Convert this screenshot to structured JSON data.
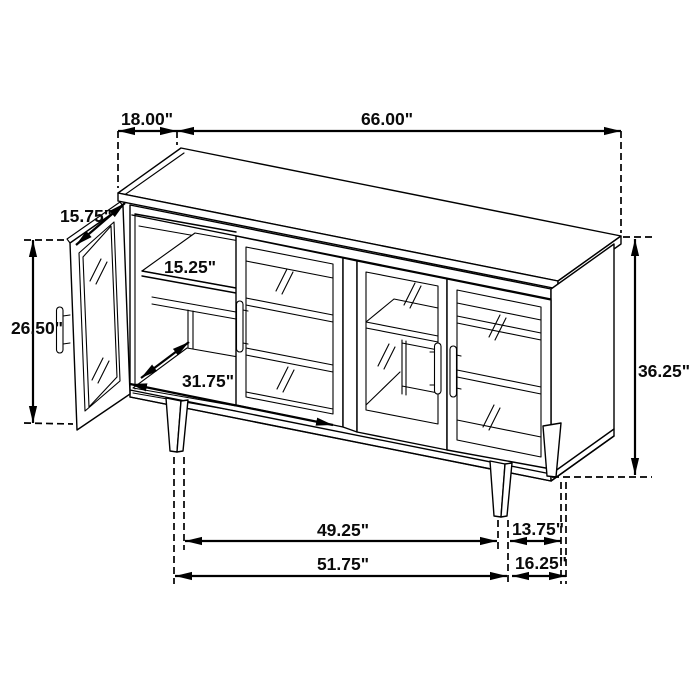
{
  "figure": {
    "type": "furniture-dimension-diagram",
    "subject_label": "sideboard cabinet line drawing, left glass door open",
    "units": "inches"
  },
  "colors": {
    "line": "#000000",
    "background": "#ffffff",
    "text": "#0a0a0a"
  },
  "dimensions": {
    "top_depth": "18.00\"",
    "top_width": "66.00\"",
    "door_width": "15.75\"",
    "door_height": "26.50\"",
    "shelf_depth": "15.25\"",
    "interior_width": "31.75\"",
    "overall_height": "36.25\"",
    "front_leg_span": "49.25\"",
    "leg_to_side": "13.75\"",
    "base_width": "51.75\"",
    "side_leg_span": "16.25\""
  }
}
